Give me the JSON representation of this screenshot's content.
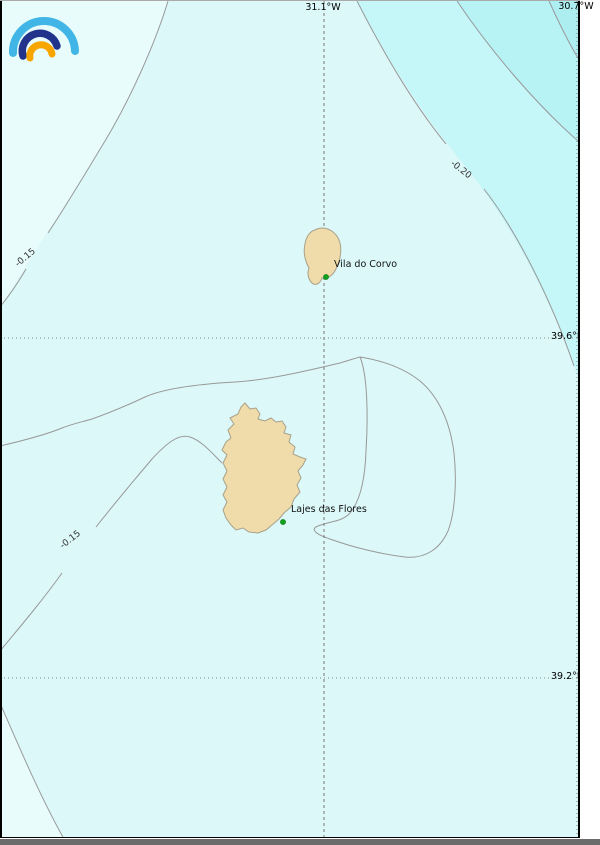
{
  "map": {
    "title": "sea-level contour map of Corvo and Flores (Azores)",
    "grid": {
      "top_labels": [
        {
          "text": "31.1°W"
        },
        {
          "text": "30.7°W"
        }
      ],
      "right_labels": [
        {
          "text": "39.6°N"
        },
        {
          "text": "39.2°N"
        }
      ]
    },
    "contour_labels": [
      {
        "text": "-0.15",
        "position": "upper-left"
      },
      {
        "text": "-0.20",
        "position": "upper-right"
      },
      {
        "text": "-0.15",
        "position": "mid-left"
      }
    ],
    "places": [
      {
        "name": "Vila do Corvo",
        "marker": "green-dot"
      },
      {
        "name": "Lajes das Flores",
        "marker": "green-dot"
      }
    ],
    "colors": {
      "sea_main": "#dcf8f9",
      "sea_light": "#e8fcfc",
      "sea_band1": "#c5f6f8",
      "sea_band2": "#b7f2f5",
      "sea_band3": "#adeef1",
      "island_fill": "#f0dcab",
      "island_border": "#a8a089",
      "contour_line": "#999999",
      "grid_line": "#888888",
      "marker_green": "#0fa01c",
      "frame_border": "#000000",
      "bottom_strip": "#6b6b6b"
    },
    "logo": {
      "name": "ipma-logo",
      "arc_colors": [
        "#41b6e6",
        "#21338b",
        "#f7a600"
      ]
    }
  }
}
